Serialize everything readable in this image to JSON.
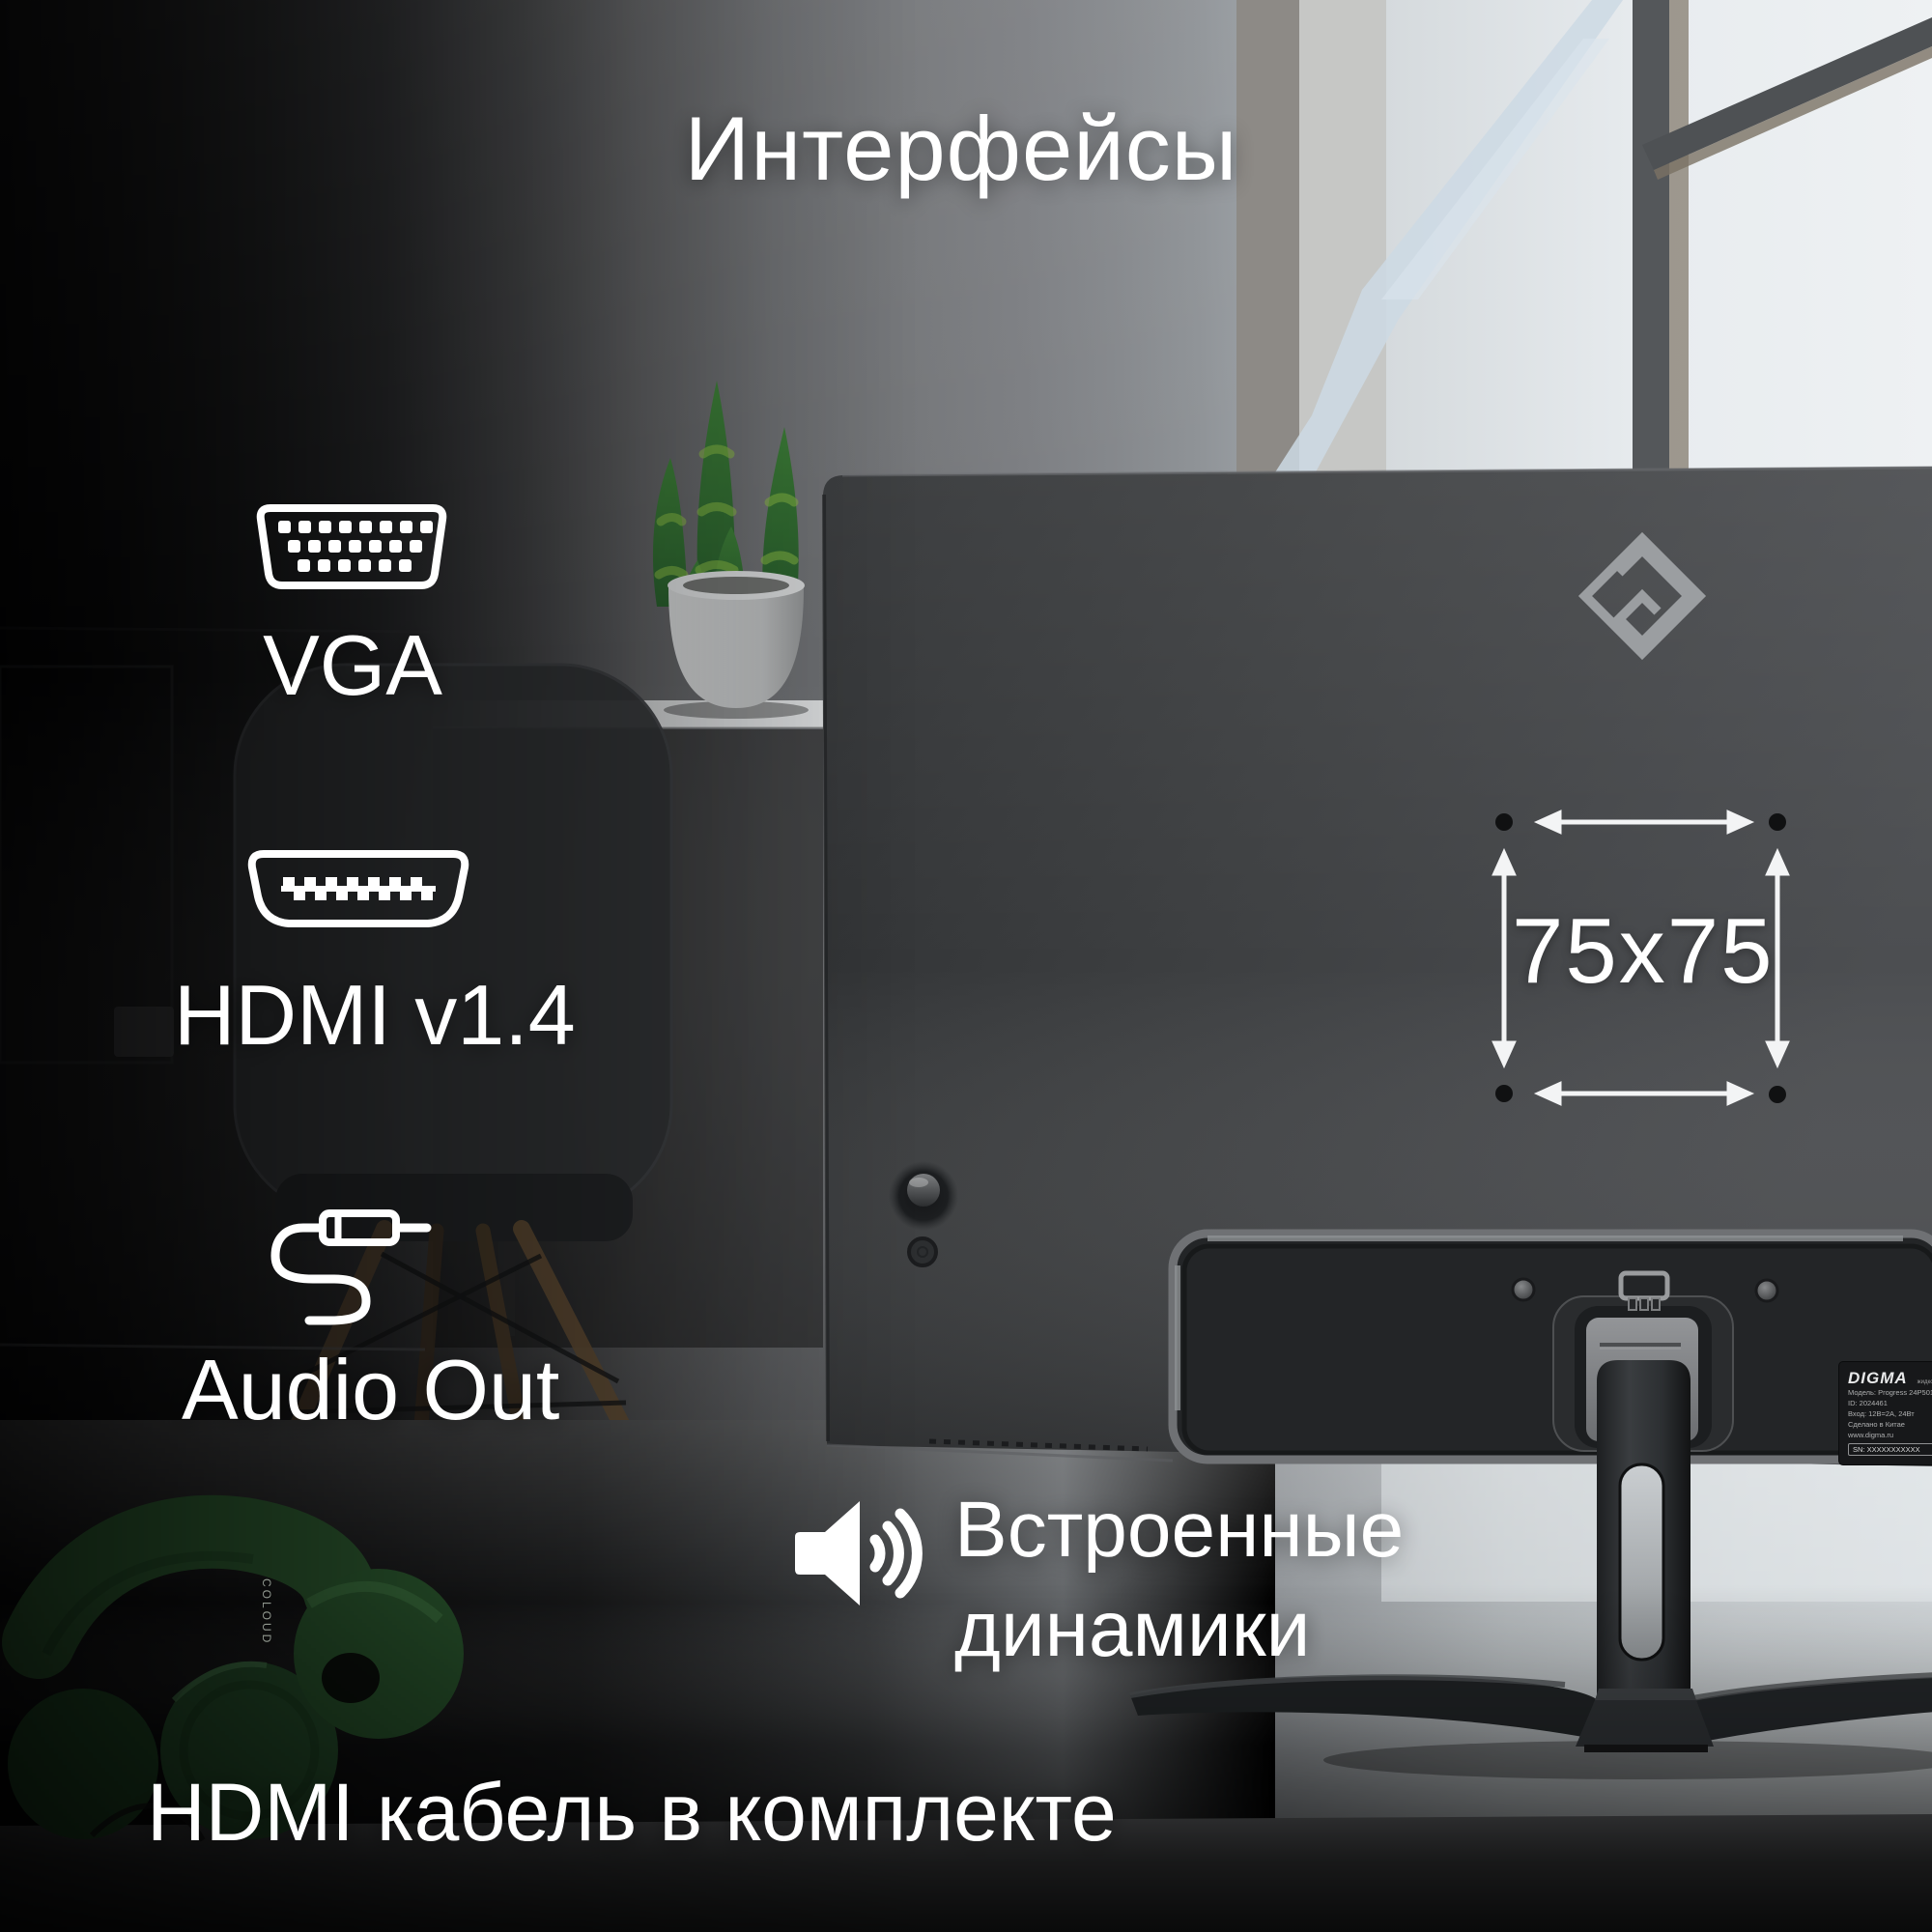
{
  "title": "Интерфейсы",
  "ports": {
    "vga": {
      "label": "VGA",
      "icon": "vga-connector-icon"
    },
    "hdmi": {
      "label": "HDMI v1.4",
      "icon": "hdmi-connector-icon"
    },
    "audio": {
      "label": "Audio Out",
      "icon": "audio-jack-icon"
    }
  },
  "vesa": {
    "size_label": "75x75"
  },
  "speakers": {
    "line1": "Встроенные",
    "line2": "динамики",
    "icon": "speaker-icon"
  },
  "footnote": "HDMI кабель в комплекте",
  "monitor": {
    "brand_logo": "digma-emblem",
    "label": {
      "brand": "DIGMA",
      "device_type": "жидкокр. монитор",
      "model": "Модель: Progress 24P501F",
      "device_id": "ID: 2024461",
      "power": "Вход: 12В=2А, 24Вт",
      "origin": "Сделано в Китае",
      "website": "www.digma.ru",
      "version": "V1.20",
      "serial": "SN: XXXXXXXXXXX"
    }
  },
  "headphones": {
    "brand": "COLOUD"
  },
  "colors": {
    "text": "#ffffff",
    "monitor_body": "#3f4143",
    "accent_green": "#2f6d33",
    "desk_highlight": "#ccd1d4"
  }
}
